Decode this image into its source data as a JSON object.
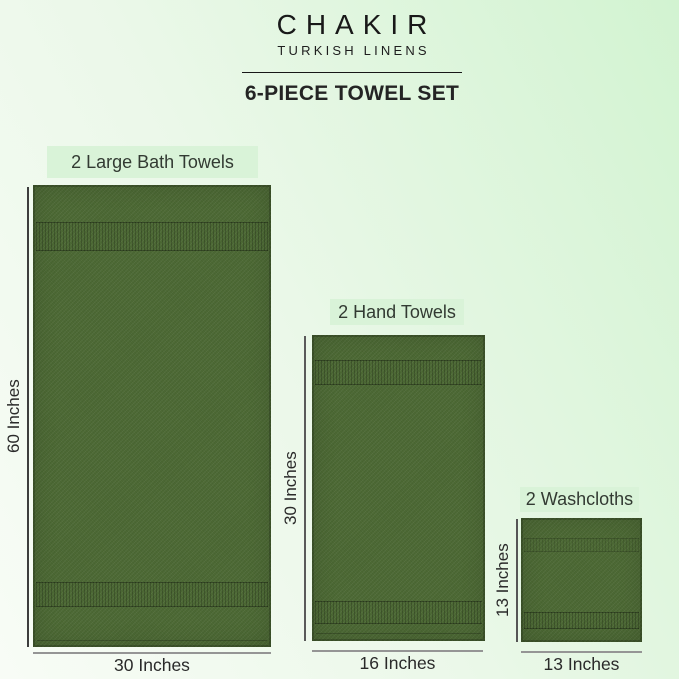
{
  "brand": {
    "name": "CHAKIR",
    "subtitle": "TURKISH LINENS"
  },
  "title": "6-PIECE TOWEL SET",
  "items": [
    {
      "label": "2 Large Bath Towels",
      "height_label": "60 Inches",
      "width_label": "30 Inches"
    },
    {
      "label": "2 Hand Towels",
      "height_label": "30 Inches",
      "width_label": "16 Inches"
    },
    {
      "label": "2 Washcloths",
      "height_label": "13 Inches",
      "width_label": "13 Inches"
    }
  ],
  "colors": {
    "towel_green": "#4d6a35",
    "label_bg": "#d9f3d8",
    "bg_left": "#f8fcf6",
    "bg_mid": "#ebf8e9",
    "bg_right": "#d2f3d1",
    "text": "#242424"
  }
}
